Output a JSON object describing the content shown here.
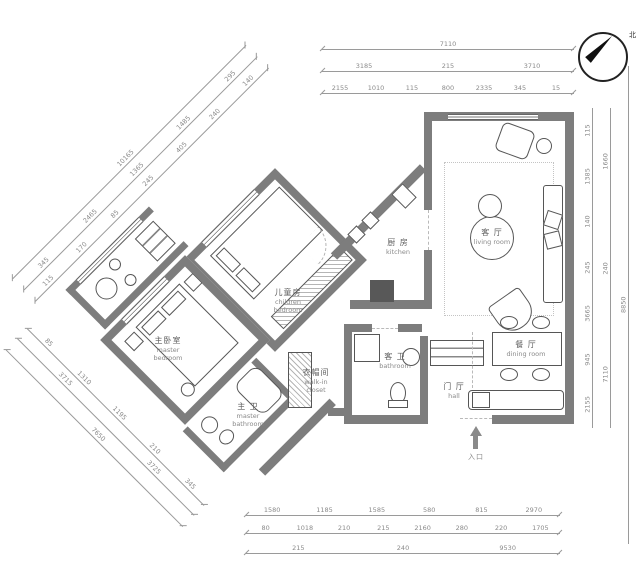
{
  "title": "apartment-floor-plan",
  "colors": {
    "wall": "#7d7d7d",
    "line": "#565656",
    "dim": "#9a9a9a",
    "dimtext": "#8a8a8a"
  },
  "compass": {
    "north": "北"
  },
  "entrance": {
    "label": "入口"
  },
  "rooms": {
    "living": {
      "zh": "客 厅",
      "en": "living room"
    },
    "kitchen": {
      "zh": "厨 房",
      "en": "kitchen"
    },
    "children": {
      "zh": "儿童房",
      "en": "children bedroom"
    },
    "master": {
      "zh": "主卧室",
      "en": "master bedroom"
    },
    "dining": {
      "zh": "餐 厅",
      "en": "dining room"
    },
    "hall": {
      "zh": "门 厅",
      "en": "hall"
    },
    "bath_guest": {
      "zh": "客 卫",
      "en": "bathroom"
    },
    "bath_master": {
      "zh": "主 卫",
      "en": "master bathroom"
    },
    "closet": {
      "zh": "衣帽间",
      "en": "walk-in closet"
    }
  },
  "dims": {
    "top": {
      "row1": [
        "7110"
      ],
      "row2": [
        "3185",
        "215",
        "3710"
      ],
      "row3": [
        "2155",
        "1010",
        "115",
        "800",
        "2335",
        "345",
        "15"
      ]
    },
    "right": {
      "row1": [
        "8850"
      ],
      "row2": [
        "1660",
        "240",
        "7110"
      ],
      "row3": [
        "115",
        "1385",
        "140",
        "245",
        "3665",
        "945",
        "2155"
      ]
    },
    "bottom": {
      "row1": [
        "1580",
        "1185",
        "1585",
        "580",
        "815",
        "2970"
      ],
      "row2": [
        "80",
        "1018",
        "210",
        "215",
        "2160",
        "280",
        "220",
        "1705"
      ],
      "row3": [
        "215",
        "240",
        "9530"
      ]
    },
    "diag_upper": {
      "row1": [
        "10165"
      ],
      "row2": [
        "345",
        "2465",
        "1365",
        "1485",
        "295"
      ],
      "row3": [
        "115",
        "170",
        "85",
        "245",
        "405",
        "240",
        "140"
      ]
    },
    "diag_lower": {
      "row1": [
        "85",
        "1310",
        "1195",
        "210",
        "345"
      ],
      "row2": [
        "3715",
        "3725"
      ],
      "row3": [
        "7650"
      ]
    }
  }
}
